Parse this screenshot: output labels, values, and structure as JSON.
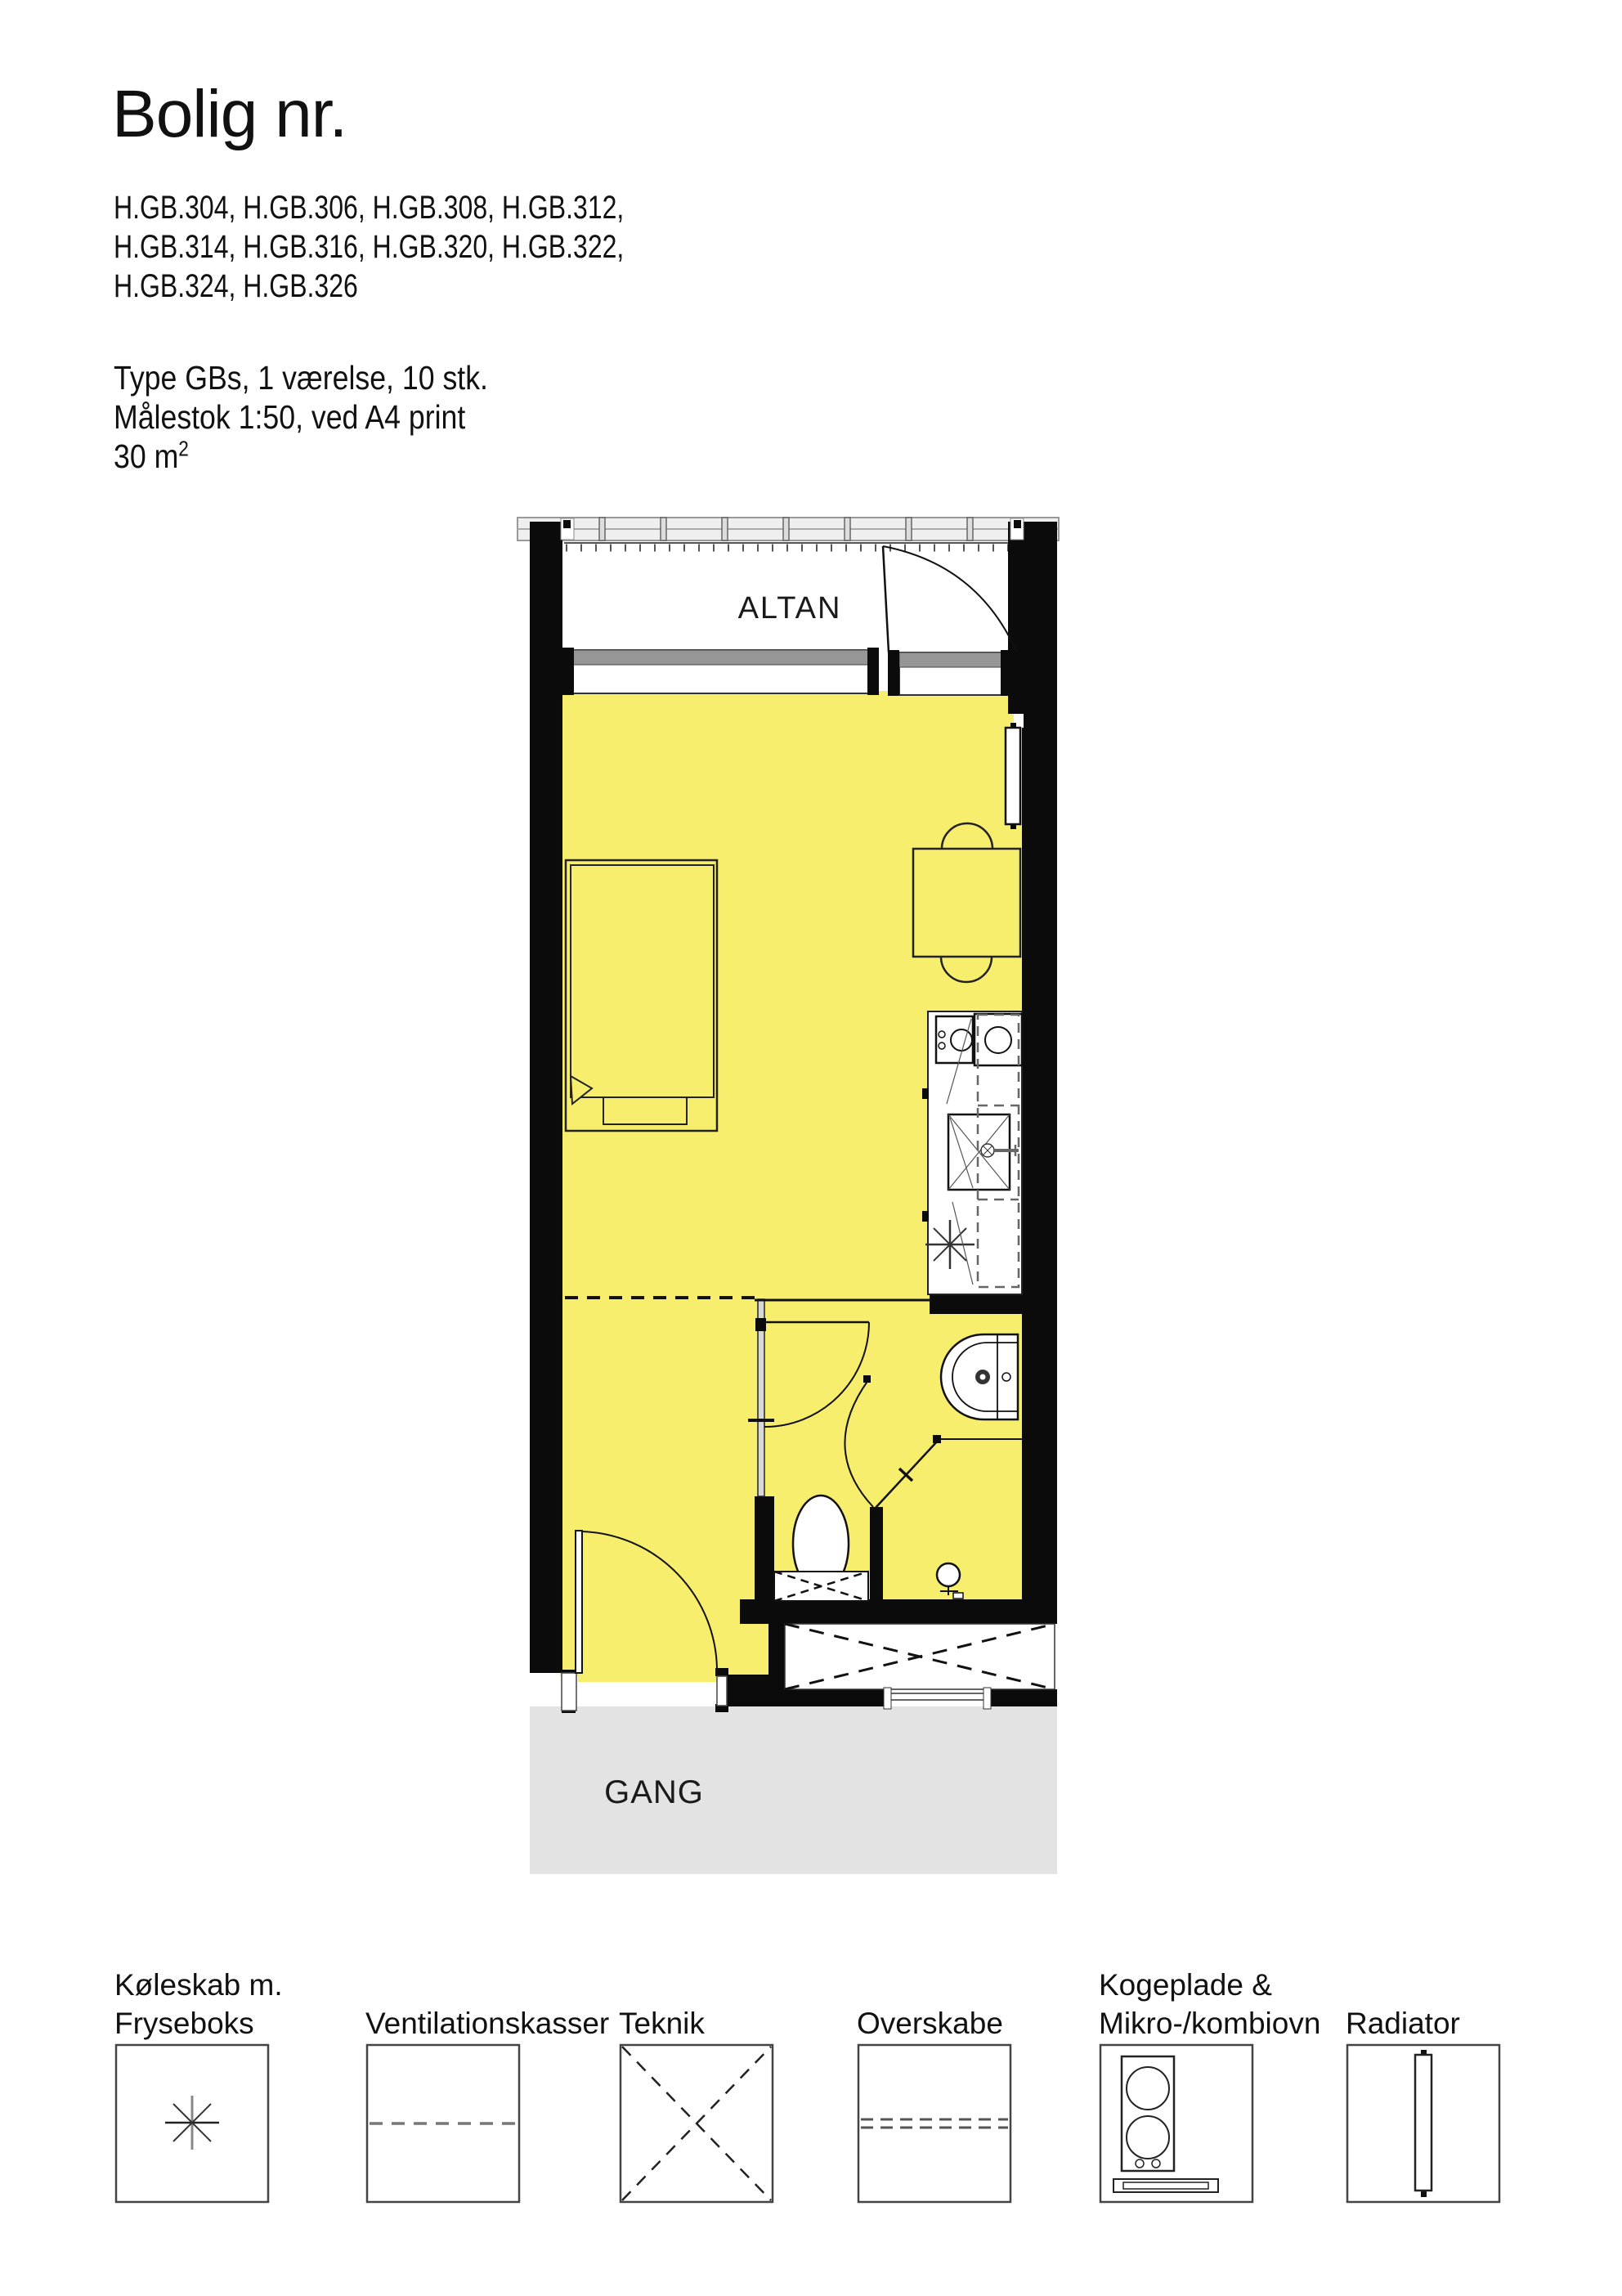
{
  "title": "Bolig nr.",
  "apartment_numbers": [
    "H.GB.304, H.GB.306, H.GB.308, H.GB.312,",
    "H.GB.314, H.GB.316, H.GB.320, H.GB.322,",
    "H.GB.324, H.GB.326"
  ],
  "details": {
    "type": "Type GBs, 1 værelse, 10 stk.",
    "scale": "Målestok 1:50, ved A4 print",
    "area_base": "30 m",
    "area_exponent": "2"
  },
  "plan": {
    "balcony_label": "ALTAN",
    "hallway_label": "GANG",
    "colors": {
      "floor": "#f7ee6e",
      "hallway_floor": "#e3e3e3",
      "wall": "#0b0b0b",
      "window_band": "#969696",
      "railing": "#bfbfbf"
    }
  },
  "legend": {
    "items": [
      {
        "line1": "Køleskab m.",
        "line2": "Fryseboks",
        "symbol": "fridge-freezer-asterisk"
      },
      {
        "line1": "Ventilationskasser",
        "line2": "",
        "symbol": "dashed-line"
      },
      {
        "line1": "Teknik",
        "line2": "",
        "symbol": "dashed-cross"
      },
      {
        "line1": "Overskabe",
        "line2": "",
        "symbol": "double-dashed-line"
      },
      {
        "line1": "Kogeplade &",
        "line2": "Mikro-/kombiovn",
        "symbol": "cooktop-micro-oven"
      },
      {
        "line1": "Radiator",
        "line2": "",
        "symbol": "radiator"
      }
    ]
  }
}
